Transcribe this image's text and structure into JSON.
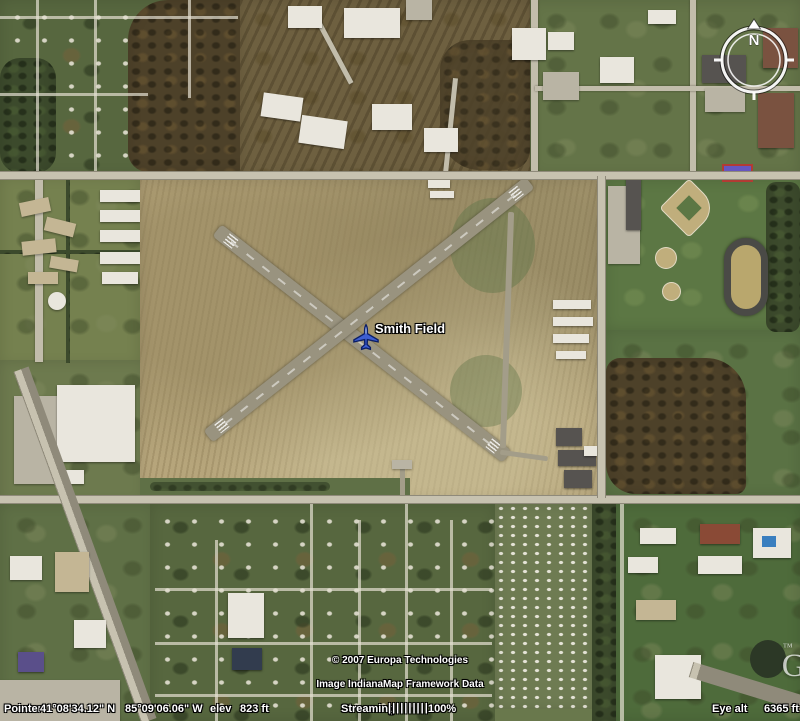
{
  "app": {
    "name": "Google Earth satellite view"
  },
  "map": {
    "placemark": {
      "label": "Smith Field",
      "icon": "airplane",
      "icon_color": "#3d5ed2"
    },
    "compass": {
      "north_label": "N"
    },
    "watermark": {
      "logo": "Google",
      "tm": "™"
    },
    "attribution": {
      "line1": "© 2007 Europa Technologies",
      "line2": "Image IndianaMap Framework Data"
    }
  },
  "status_bar": {
    "pointer_label": "Pointer",
    "latitude": "41°08'34.12\" N",
    "longitude": "85°09'06.06\" W",
    "elev_label": "elev",
    "elevation": "823 ft",
    "streaming_label": "Streaming",
    "streaming_bars": "||||||||||",
    "streaming_percent": "100%",
    "eye_alt_label": "Eye alt",
    "eye_altitude": "6365 ft"
  }
}
